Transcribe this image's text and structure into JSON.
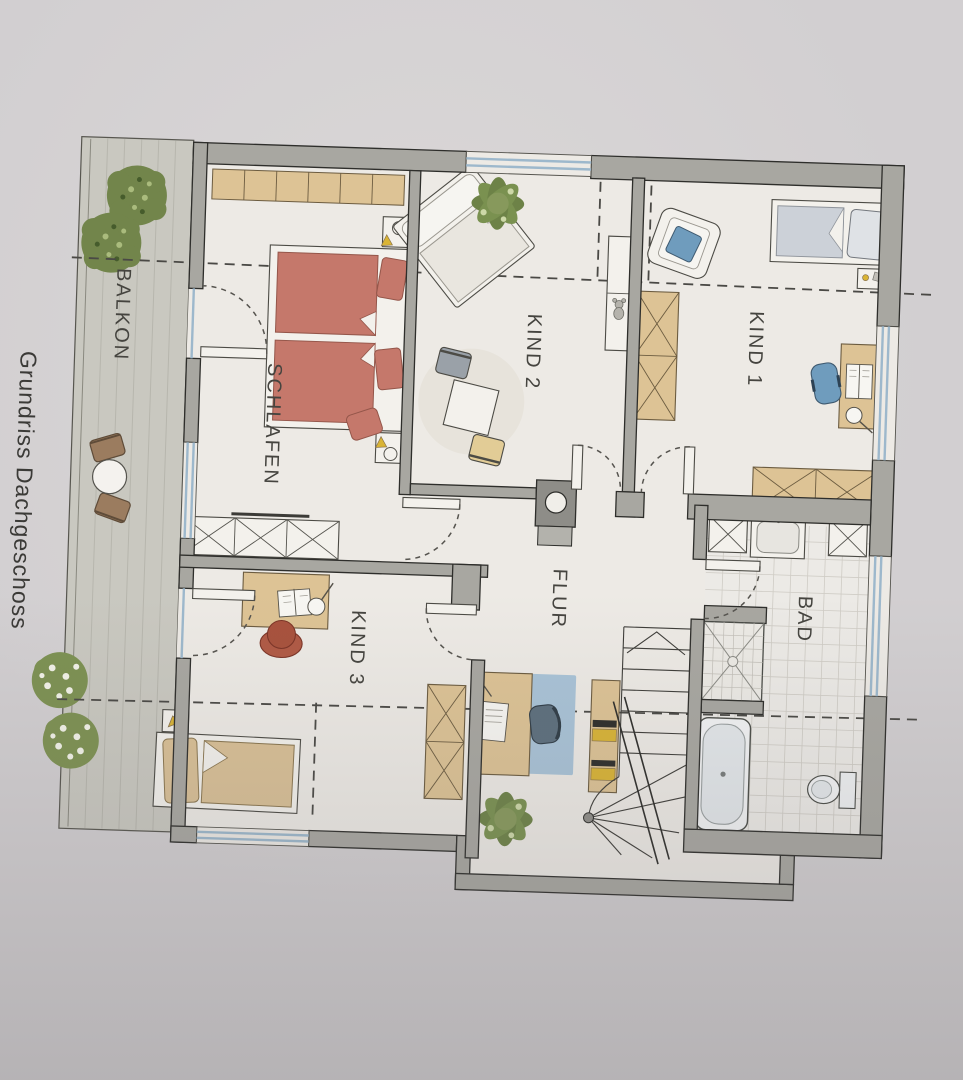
{
  "title": "Grundriss Dachgeschoss",
  "labels": {
    "balcony": "BALKON",
    "bedroom": "SCHLAFEN",
    "child1": "KIND 1",
    "child2": "KIND 2",
    "child3": "KIND 3",
    "hallway": "FLUR",
    "bathroom": "BAD"
  },
  "colors": {
    "page_bg": "#d2cfd1",
    "floor": "#edeae5",
    "wall_gray": "#a8a7a1",
    "wood_tan": "#ddc395",
    "bed_red": "#c5786b",
    "accent_blue": "#6f9cbd",
    "rug_blue": "#a9c3d7",
    "window_blue": "#9db8cc",
    "plant_green": "#72854b",
    "deck_gray": "#c9c8c0",
    "chair_rust": "#b05a45",
    "chair_brown": "#9b7c5f",
    "book_yellow": "#d9b435"
  }
}
